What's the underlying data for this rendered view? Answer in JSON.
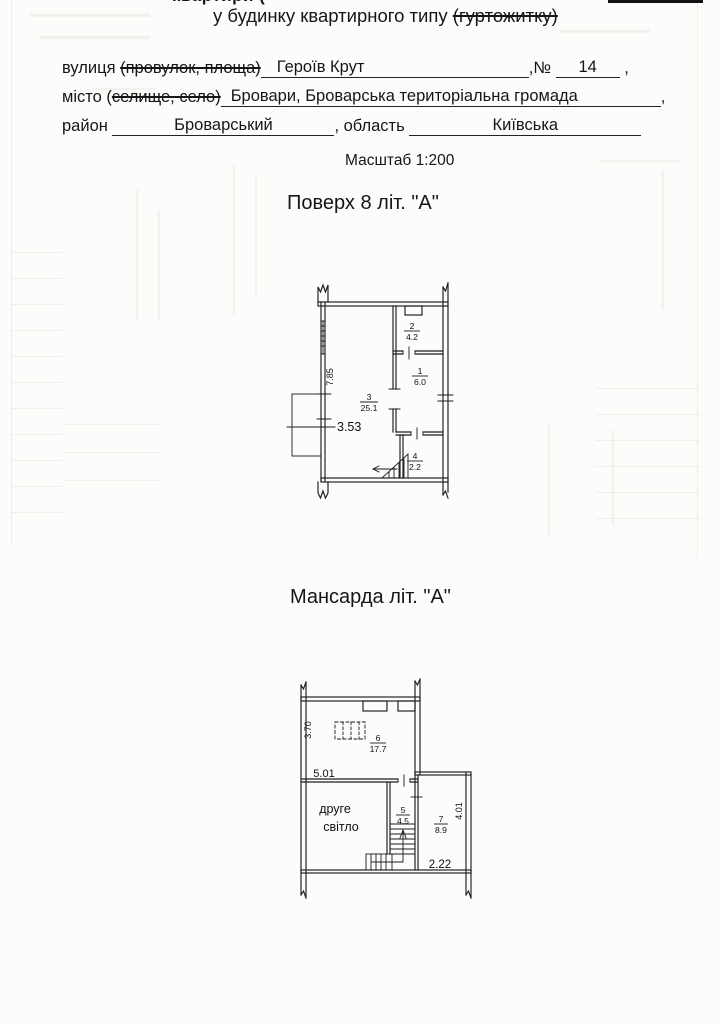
{
  "document": {
    "clipped_top_line": "квартири (",
    "title": "у будинку квартирного типу",
    "title_struck": "(гуртожитку)",
    "scale": "Масштаб 1:200"
  },
  "address": {
    "street_label": "вулиця",
    "street_struck": "(провулок, площа)",
    "street_value": "Героїв Крут",
    "number_label": ",№",
    "number_value": "14",
    "comma": ",",
    "city_label": "місто (",
    "city_struck": "селище, село)",
    "city_value": "Бровари, Броварська територіальна громада",
    "district_label": "район",
    "district_value": "Броварський",
    "region_label": ", область",
    "region_value": "Київська"
  },
  "floor_plan": {
    "title": "Поверх 8 літ. \"А\"",
    "dim_height": "7.85",
    "dim_width": "3.53",
    "rooms": {
      "r1": {
        "num": "1",
        "area": "6.0"
      },
      "r2": {
        "num": "2",
        "area": "4.2"
      },
      "r3": {
        "num": "3",
        "area": "25.1"
      },
      "r4": {
        "num": "4",
        "area": "2.2"
      }
    }
  },
  "attic_plan": {
    "title": "Мансарда літ. \"А\"",
    "dim_left": "3.70",
    "dim_top": "5.01",
    "dim_right": "4.01",
    "dim_bottom": "2.22",
    "void_line1": "друге",
    "void_line2": "світло",
    "rooms": {
      "r5": {
        "num": "5",
        "area": "4.5"
      },
      "r6": {
        "num": "6",
        "area": "17.7"
      },
      "r7": {
        "num": "7",
        "area": "8.9"
      }
    }
  }
}
